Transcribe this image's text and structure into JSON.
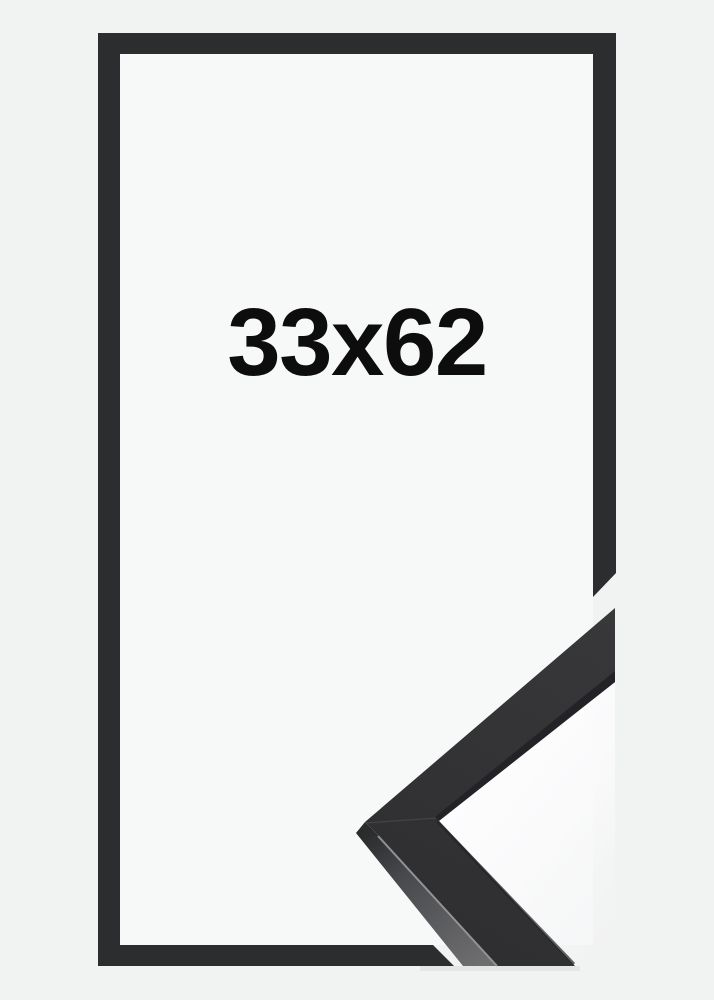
{
  "image": {
    "size_label": "33x62"
  },
  "colors": {
    "background": "#f1f2f2",
    "frame_interior": "#f7f8f8",
    "frame_outline": "#2c2d2e",
    "moulding_front_light": "#38383a",
    "moulding_front_dark": "#2e2e30",
    "moulding_side_dark": "#2a2b2d",
    "moulding_side_light": "#6e6e71",
    "moulding_lip": "#232327",
    "edge_highlight": "#9a9a9c",
    "wedge_white": "#fdfdfe",
    "label_text": "#0d0d0d"
  }
}
